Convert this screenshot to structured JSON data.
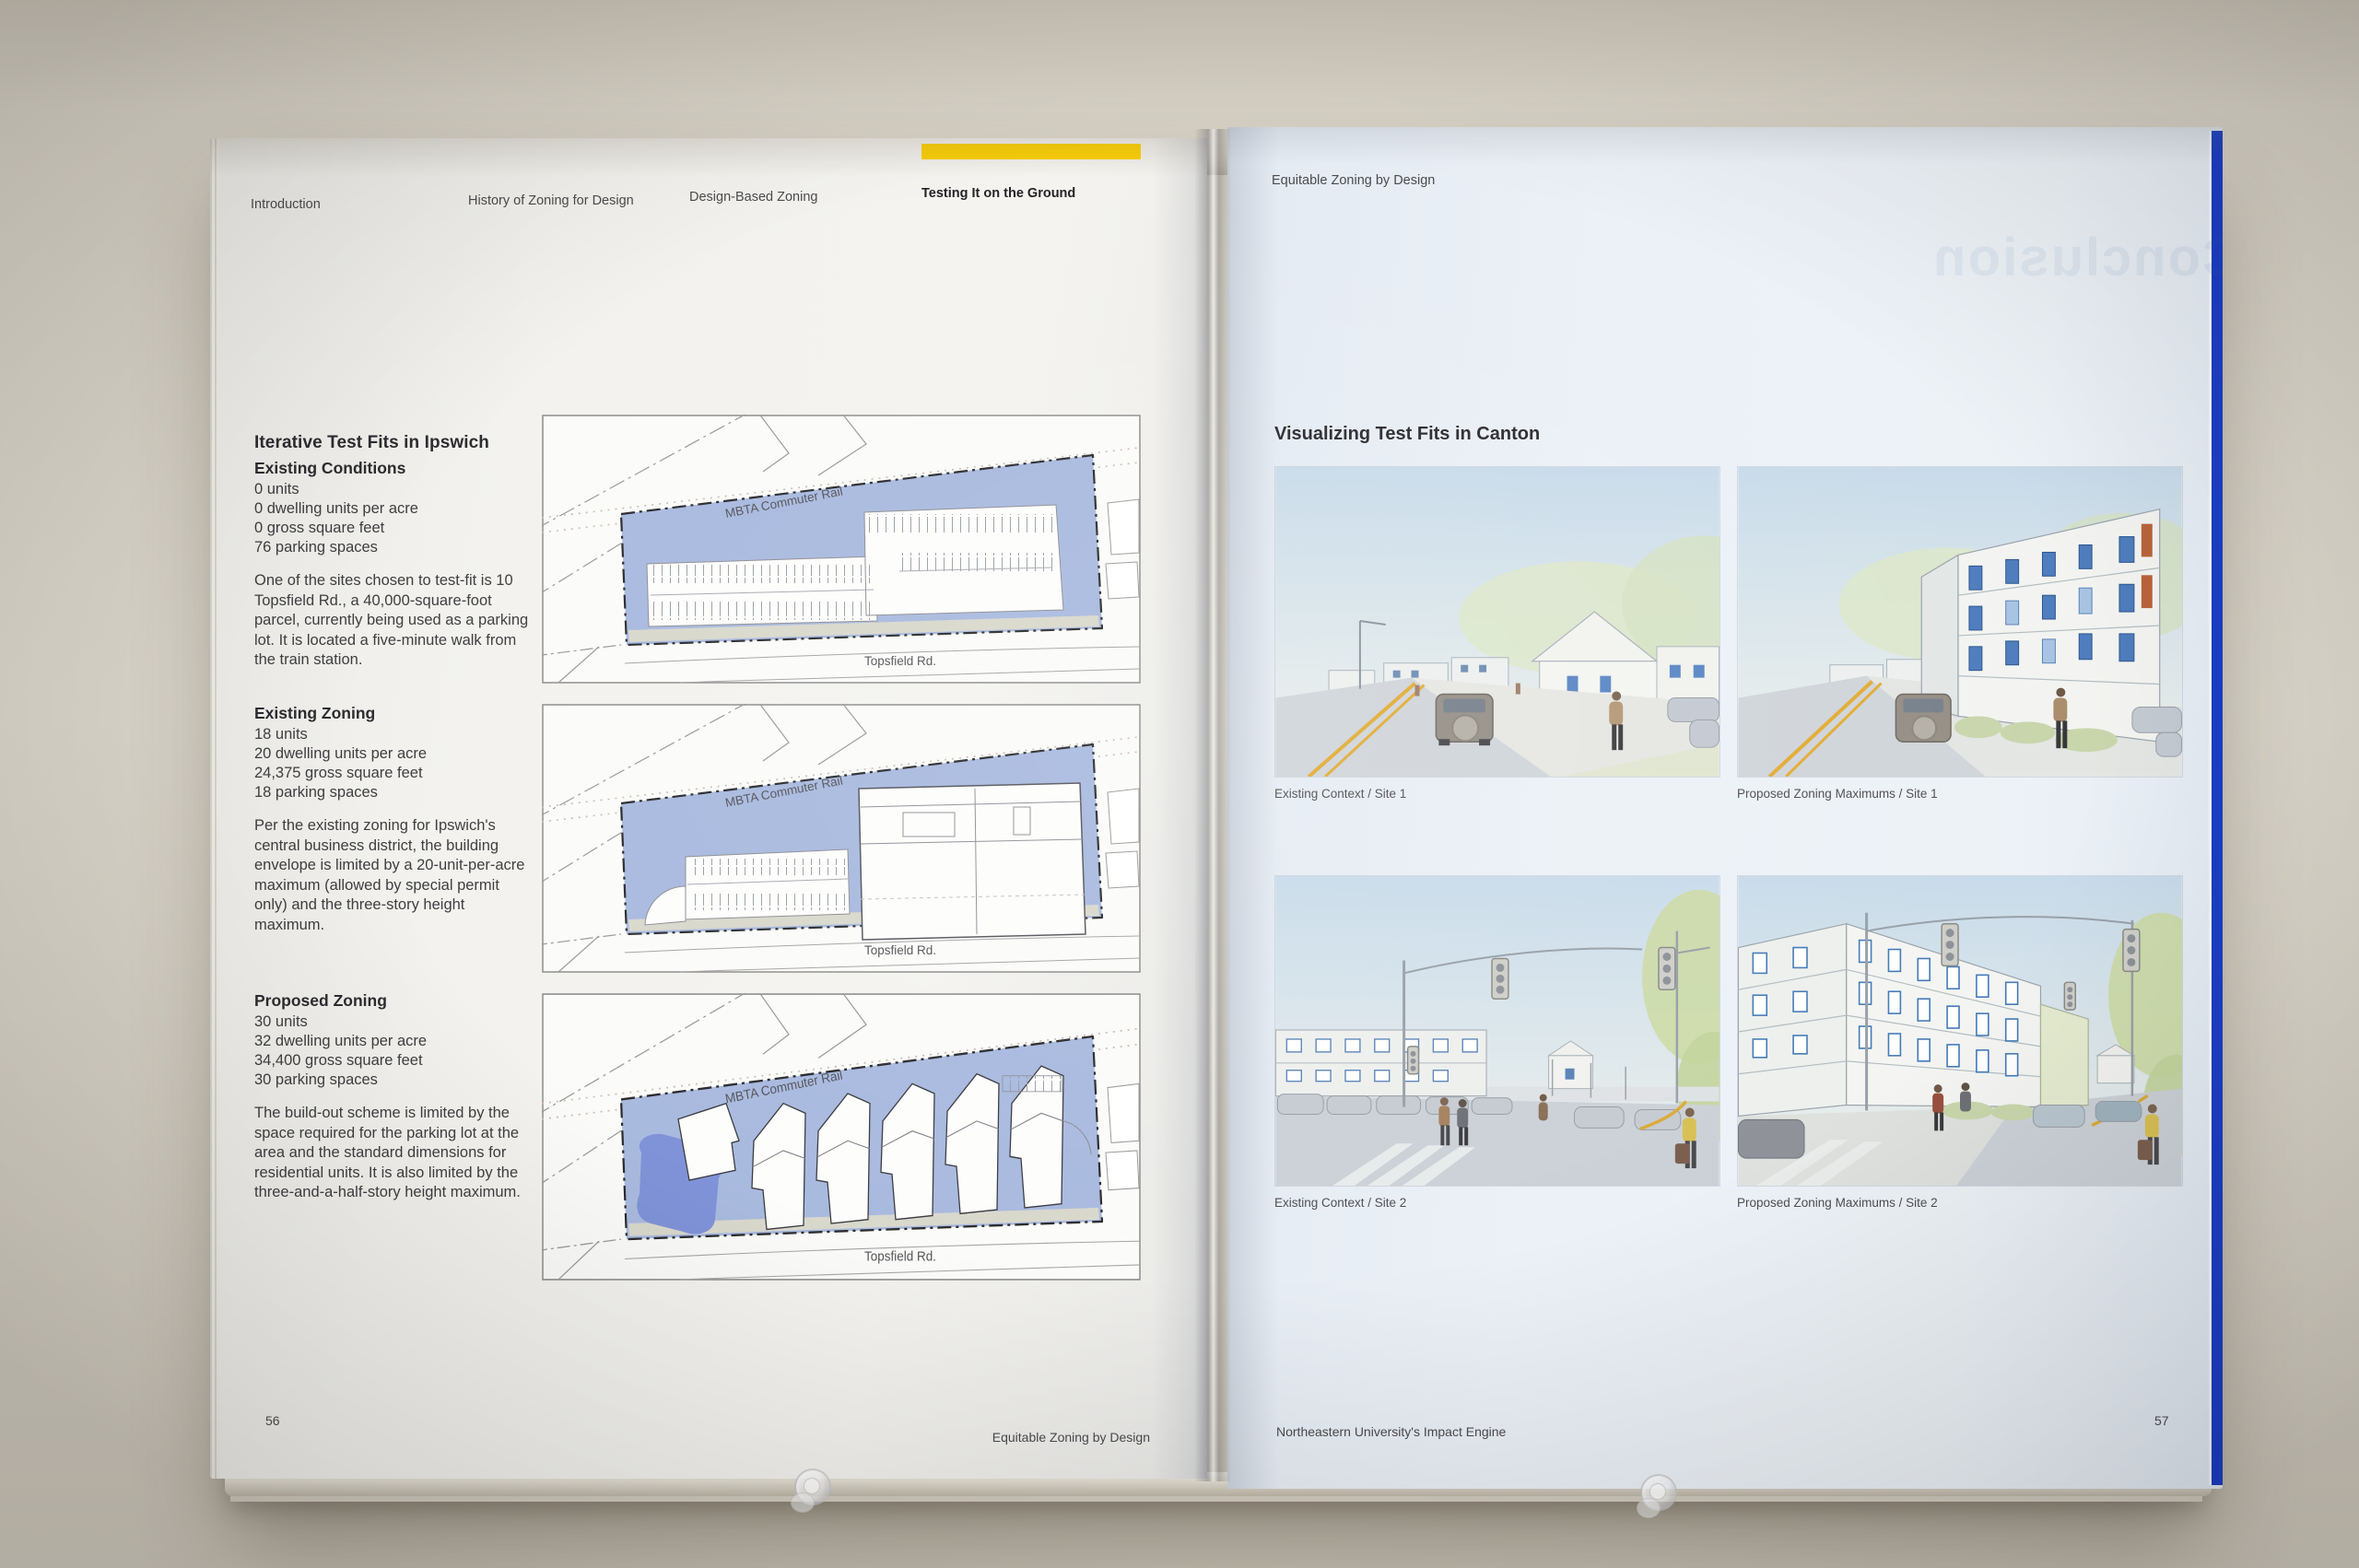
{
  "palette": {
    "wall": "#d8d3c8",
    "left_page": "#f1f0ec",
    "right_page": "#eaf0f6",
    "highlight_yellow": "#ffd200",
    "parcel_blue": "#a9badf",
    "pond_blue": "#8093d8",
    "cover_blue": "#1b3ec5",
    "ink": "#3f3e41"
  },
  "left_page": {
    "nav": {
      "items": [
        {
          "label": "Introduction",
          "active": false
        },
        {
          "label": "History of Zoning for Design",
          "active": false
        },
        {
          "label": "Design-Based Zoning",
          "active": false
        },
        {
          "label": "Testing It on the Ground",
          "active": true
        }
      ]
    },
    "article": {
      "title": "Iterative Test Fits in Ipswich",
      "sections": [
        {
          "heading": "Existing Conditions",
          "stats": [
            "0 units",
            "0 dwelling units per acre",
            "0 gross square feet",
            "76 parking spaces"
          ],
          "body": "One of the sites chosen to test-fit is 10 Topsfield Rd., a 40,000-square-foot parcel, currently being used as a parking lot. It is located a five-minute walk from the train station."
        },
        {
          "heading": "Existing Zoning",
          "stats": [
            "18 units",
            "20 dwelling units per acre",
            "24,375 gross square feet",
            "18 parking spaces"
          ],
          "body": "Per the existing zoning for Ipswich's central business district, the building envelope is limited by a 20-unit-per-acre maximum (allowed by special permit only) and the three-story height maximum."
        },
        {
          "heading": "Proposed Zoning",
          "stats": [
            "30 units",
            "32 dwelling units per acre",
            "34,400 gross square feet",
            "30 parking spaces"
          ],
          "body": "The build-out scheme is limited by the space required for the parking lot at the area and the standard dimensions for residential units. It is also limited by the three-and-a-half-story height maximum."
        }
      ]
    },
    "diagrams": {
      "rail_label": "MBTA Commuter Rail",
      "road_label": "Topsfield Rd."
    },
    "footer": {
      "page_number": "56",
      "running_title": "Equitable Zoning by Design"
    }
  },
  "right_page": {
    "header": "Equitable Zoning by Design",
    "ghost_title": "Conclusion",
    "title": "Visualizing Test Fits in Canton",
    "figures": [
      {
        "caption": "Existing Context / Site 1"
      },
      {
        "caption": "Proposed Zoning Maximums / Site 1"
      },
      {
        "caption": "Existing Context / Site 2"
      },
      {
        "caption": "Proposed Zoning Maximums / Site 2"
      }
    ],
    "footer": {
      "running_title": "Northeastern University's Impact Engine",
      "page_number": "57"
    }
  }
}
